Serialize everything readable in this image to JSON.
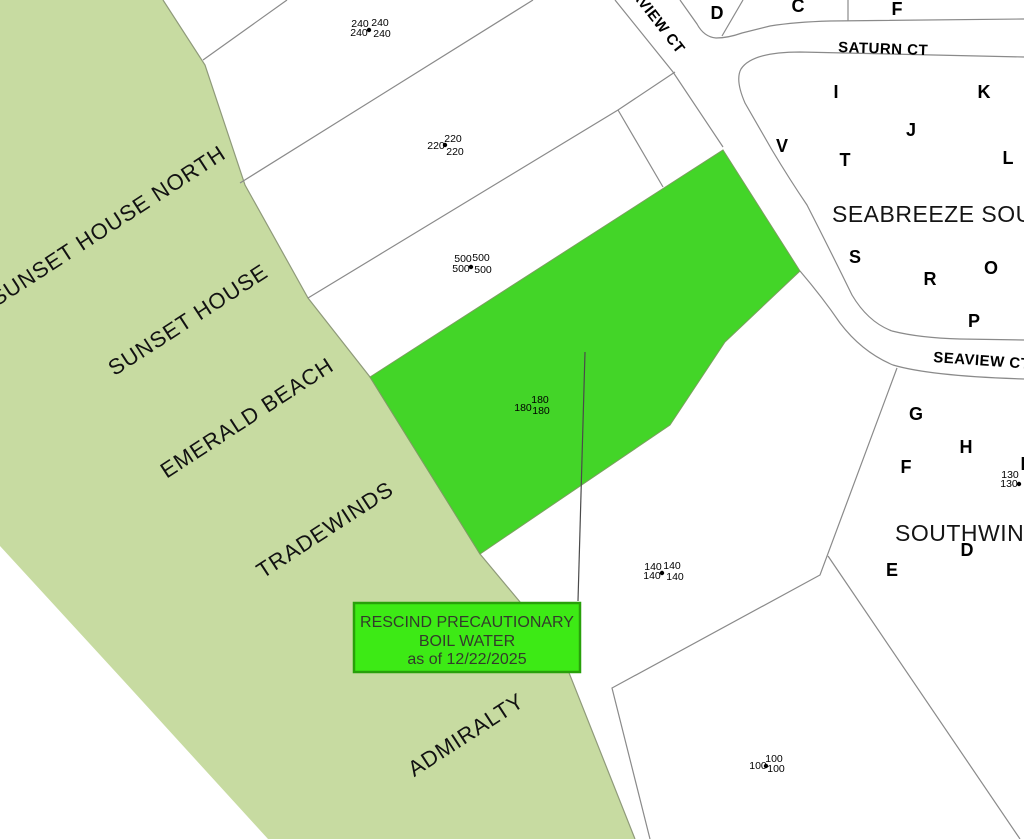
{
  "colors": {
    "background": "#ffffff",
    "beach": "#c7dba1",
    "parcel_line": "#8a8a8a",
    "highlight": "#43d528",
    "callout_fill": "#3dea15",
    "callout_border": "#28a00a"
  },
  "beach_labels": [
    "SUNSET HOUSE NORTH",
    "SUNSET HOUSE",
    "EMERALD BEACH",
    "TRADEWINDS",
    "ADMIRALTY"
  ],
  "streets": {
    "seaview_upper": "SEAVIEW CT",
    "saturn": "SATURN CT",
    "seaview_lower": "SEAVIEW CT"
  },
  "subdivisions": {
    "seabreeze": "SEABREEZE SOUTH",
    "southwind": "SOUTHWINDS"
  },
  "parcel_letters": {
    "top": [
      "D",
      "C",
      "F"
    ],
    "seabreeze": [
      "I",
      "K",
      "J",
      "V",
      "T",
      "L",
      "S",
      "R",
      "O",
      "P"
    ],
    "southwind": [
      "G",
      "H",
      "F",
      "D",
      "E"
    ],
    "edge_partial": "I"
  },
  "measurements": {
    "c240": [
      "240",
      "240",
      "240",
      "240"
    ],
    "c220": [
      "220",
      "220",
      "220"
    ],
    "c500": [
      "500",
      "500",
      "500",
      "500"
    ],
    "c180": [
      "180",
      "180",
      "180"
    ],
    "c140": [
      "140",
      "140",
      "140",
      "140"
    ],
    "c130": [
      "130",
      "130"
    ],
    "c100": [
      "100",
      "100",
      "100"
    ]
  },
  "callout": {
    "line1": "RESCIND PRECAUTIONARY",
    "line2": "BOIL WATER",
    "line3": "as of 12/22/2025"
  }
}
